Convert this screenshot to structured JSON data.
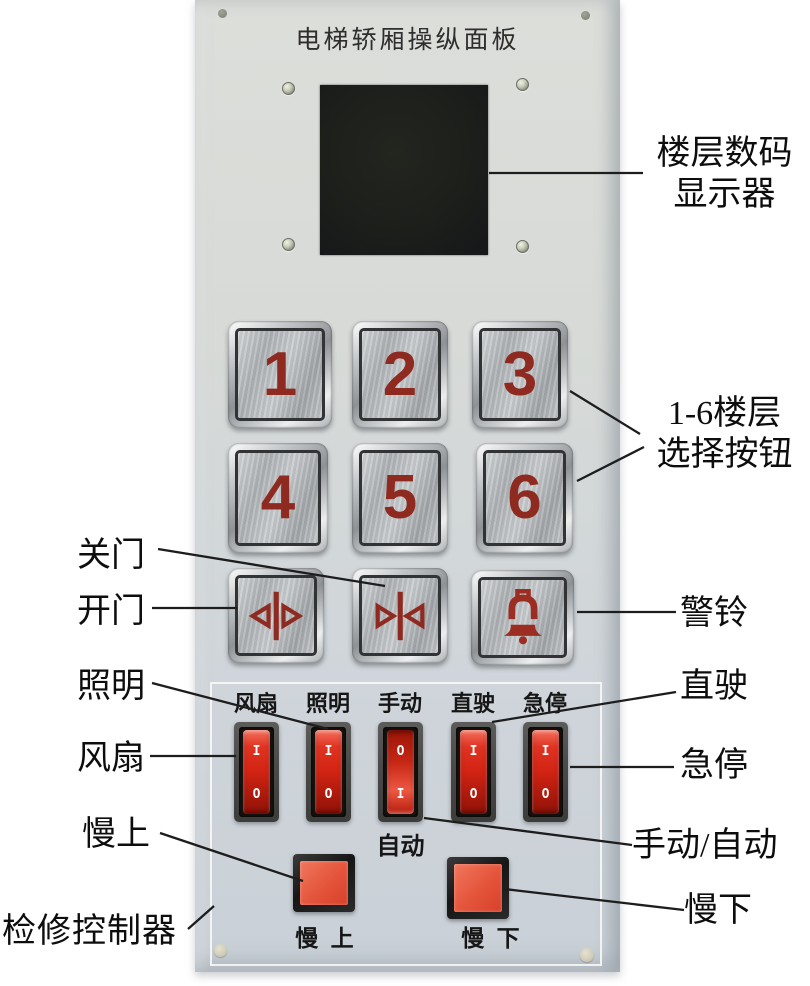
{
  "panel": {
    "title": "电梯轿厢操纵面板",
    "floor_buttons": [
      "1",
      "2",
      "3",
      "4",
      "5",
      "6"
    ],
    "switches": [
      {
        "label": "风扇",
        "top": "I",
        "bottom": "O",
        "state": "up"
      },
      {
        "label": "照明",
        "top": "I",
        "bottom": "O",
        "state": "up"
      },
      {
        "label": "手动",
        "top": "O",
        "bottom": "I",
        "state": "down"
      },
      {
        "label": "直驶",
        "top": "I",
        "bottom": "O",
        "state": "up"
      },
      {
        "label": "急停",
        "top": "I",
        "bottom": "O",
        "state": "up"
      }
    ],
    "auto_label": "自动",
    "slow_up_label": "慢 上",
    "slow_down_label": "慢 下"
  },
  "icons": {
    "door_open": "door-open-arrows-icon",
    "door_close": "door-close-arrows-icon",
    "alarm": "alarm-bell-icon"
  },
  "annotations": {
    "display_line1": "楼层数码",
    "display_line2": "显示器",
    "floors_line1": "1-6楼层",
    "floors_line2": "选择按钮",
    "close_door": "关门",
    "open_door": "开门",
    "bell": "警铃",
    "lighting": "照明",
    "fan": "风扇",
    "direct_drive": "直驶",
    "emergency_stop": "急停",
    "manual_auto": "手动/自动",
    "slow_up": "慢上",
    "slow_down": "慢下",
    "inspection_controller": "检修控制器"
  },
  "colors": {
    "panel_bg": "#d6d9d6",
    "display_bg": "#1d201d",
    "button_glyph_red": "#8e2a20",
    "rocker_red": "#d32414",
    "jog_button_red": "#e4543b",
    "switch_frame": "#4a4a48",
    "annotation_text": "#0d0d0d"
  }
}
